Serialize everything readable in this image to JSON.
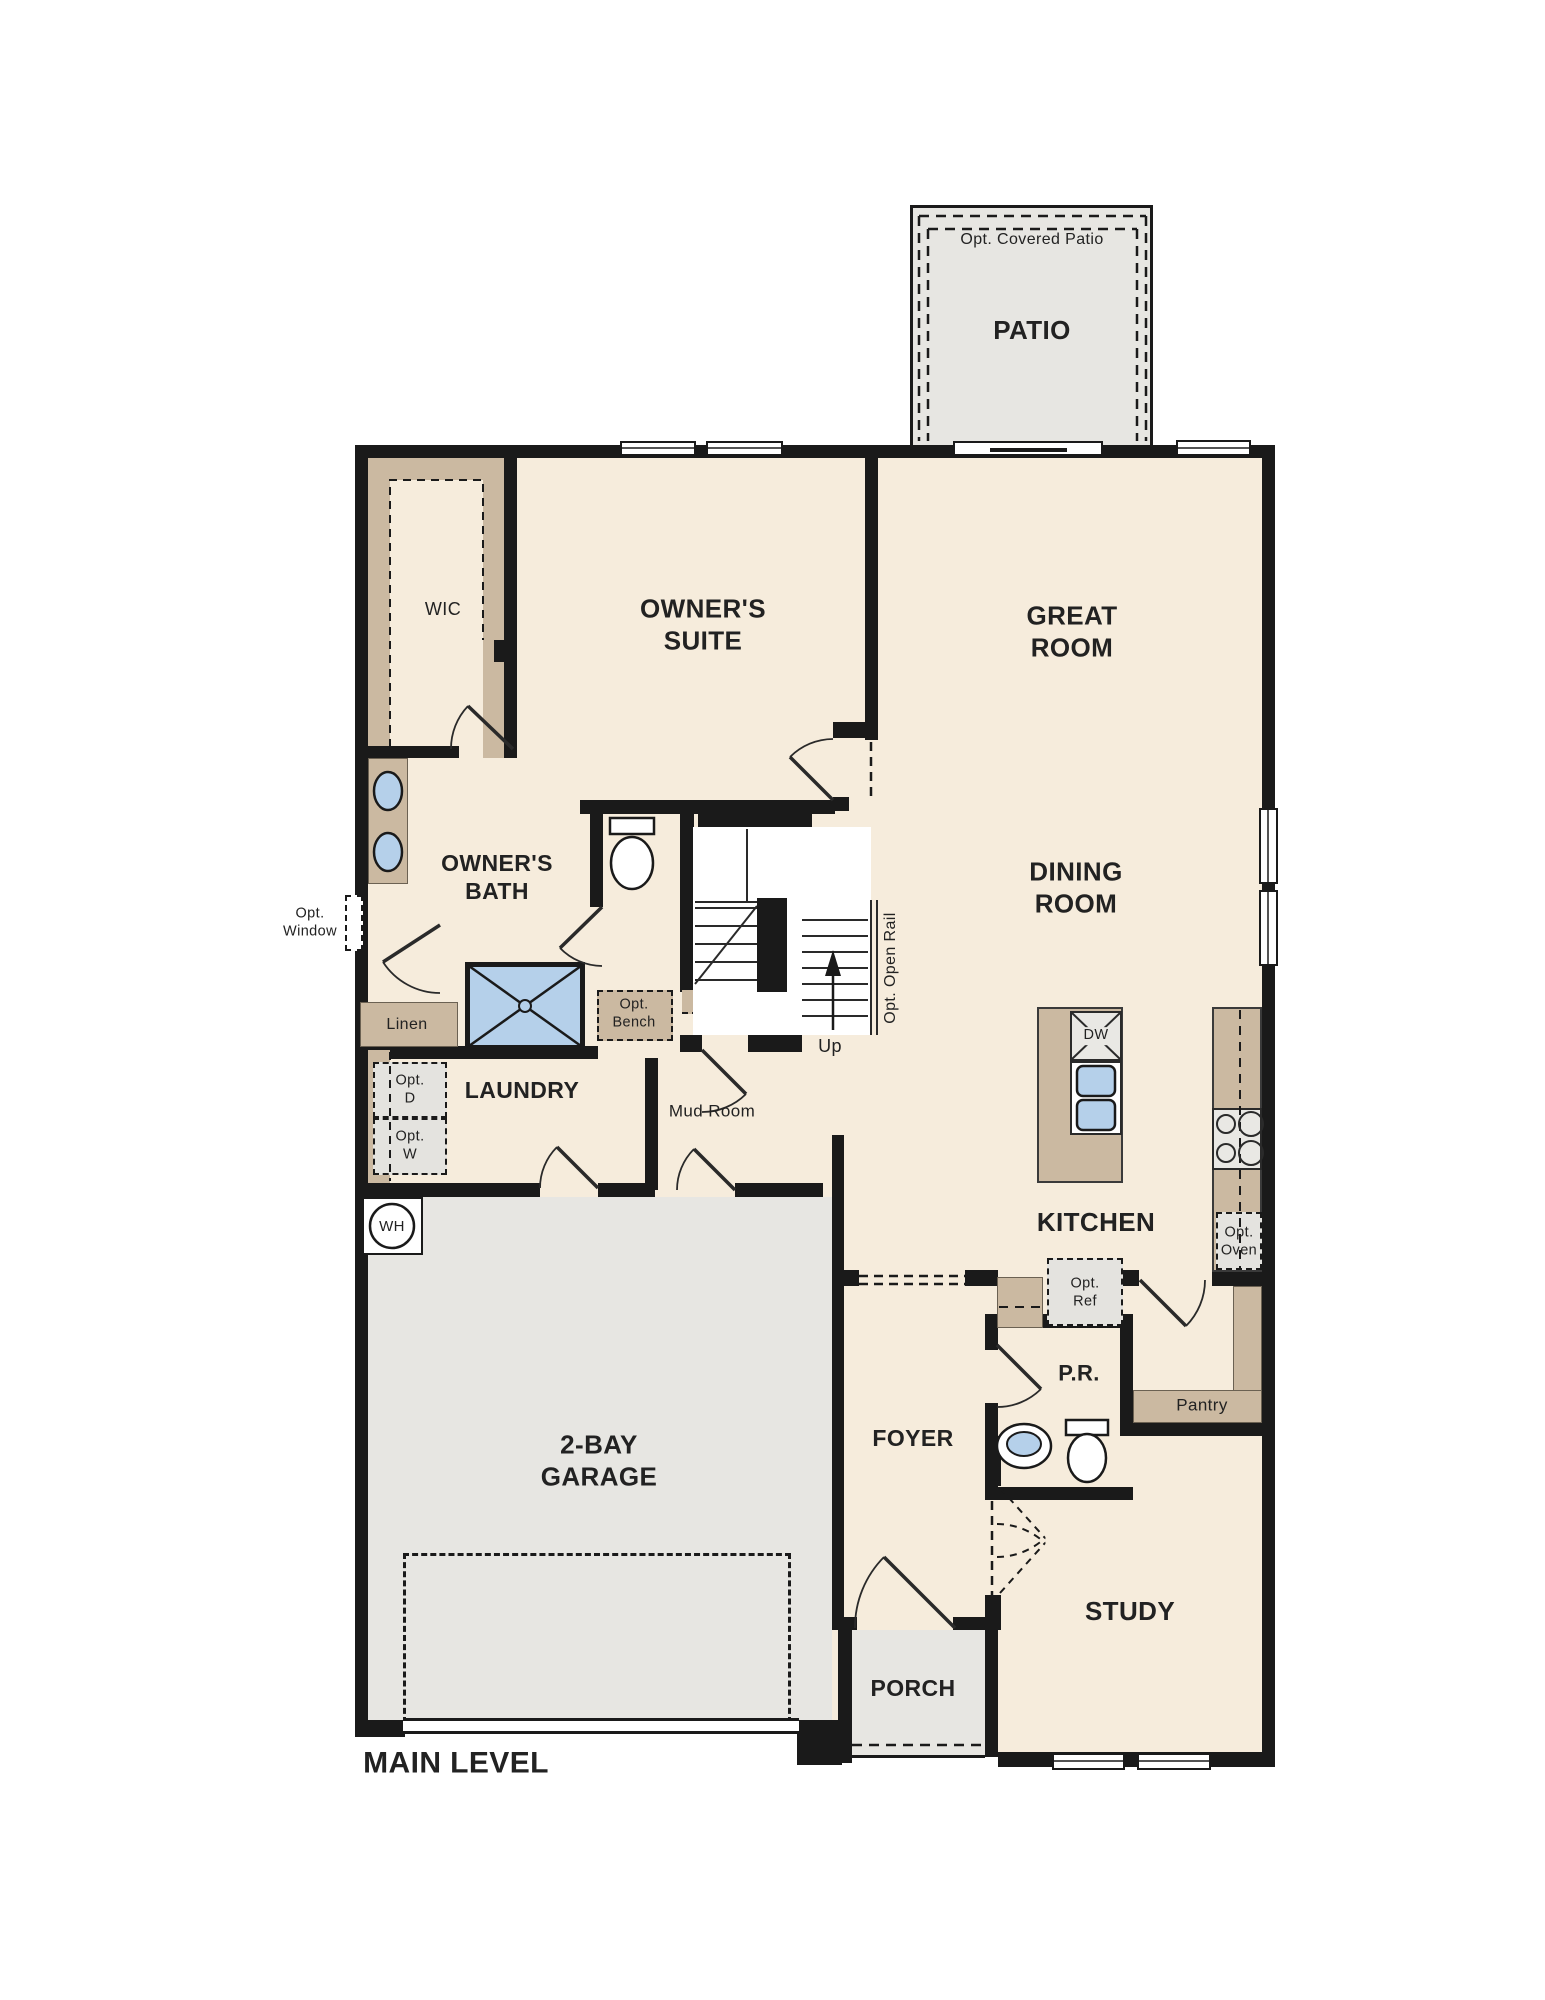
{
  "plan": {
    "title": "MAIN LEVEL",
    "colors": {
      "floor": "#f6ecdc",
      "casework_tan": "#cbb9a1",
      "concrete_gray": "#e7e6e2",
      "fixture_blue": "#b5d0ea",
      "wall_black": "#1a1a1a"
    },
    "rooms": {
      "patio": "PATIO",
      "wic": "WIC",
      "owners_suite": "OWNER'S\nSUITE",
      "great_room": "GREAT\nROOM",
      "dining_room": "DINING\nROOM",
      "owners_bath": "OWNER'S\nBATH",
      "laundry": "LAUNDRY",
      "mud_room": "Mud Room",
      "kitchen": "KITCHEN",
      "garage": "2-BAY\nGARAGE",
      "foyer": "FOYER",
      "powder_room": "P.R.",
      "pantry": "Pantry",
      "study": "STUDY",
      "porch": "PORCH"
    },
    "annotations": {
      "opt_covered_patio": "Opt. Covered Patio",
      "opt_window": "Opt.\nWindow",
      "linen": "Linen",
      "opt_bench": "Opt.\nBench",
      "opt_open_rail": "Opt. Open Rail",
      "up": "Up",
      "opt_dryer": "Opt.\nD",
      "opt_washer": "Opt.\nW",
      "water_heater": "WH",
      "dishwasher": "DW",
      "opt_oven": "Opt.\nOven",
      "opt_ref": "Opt.\nRef",
      "main_level": "MAIN LEVEL"
    }
  }
}
